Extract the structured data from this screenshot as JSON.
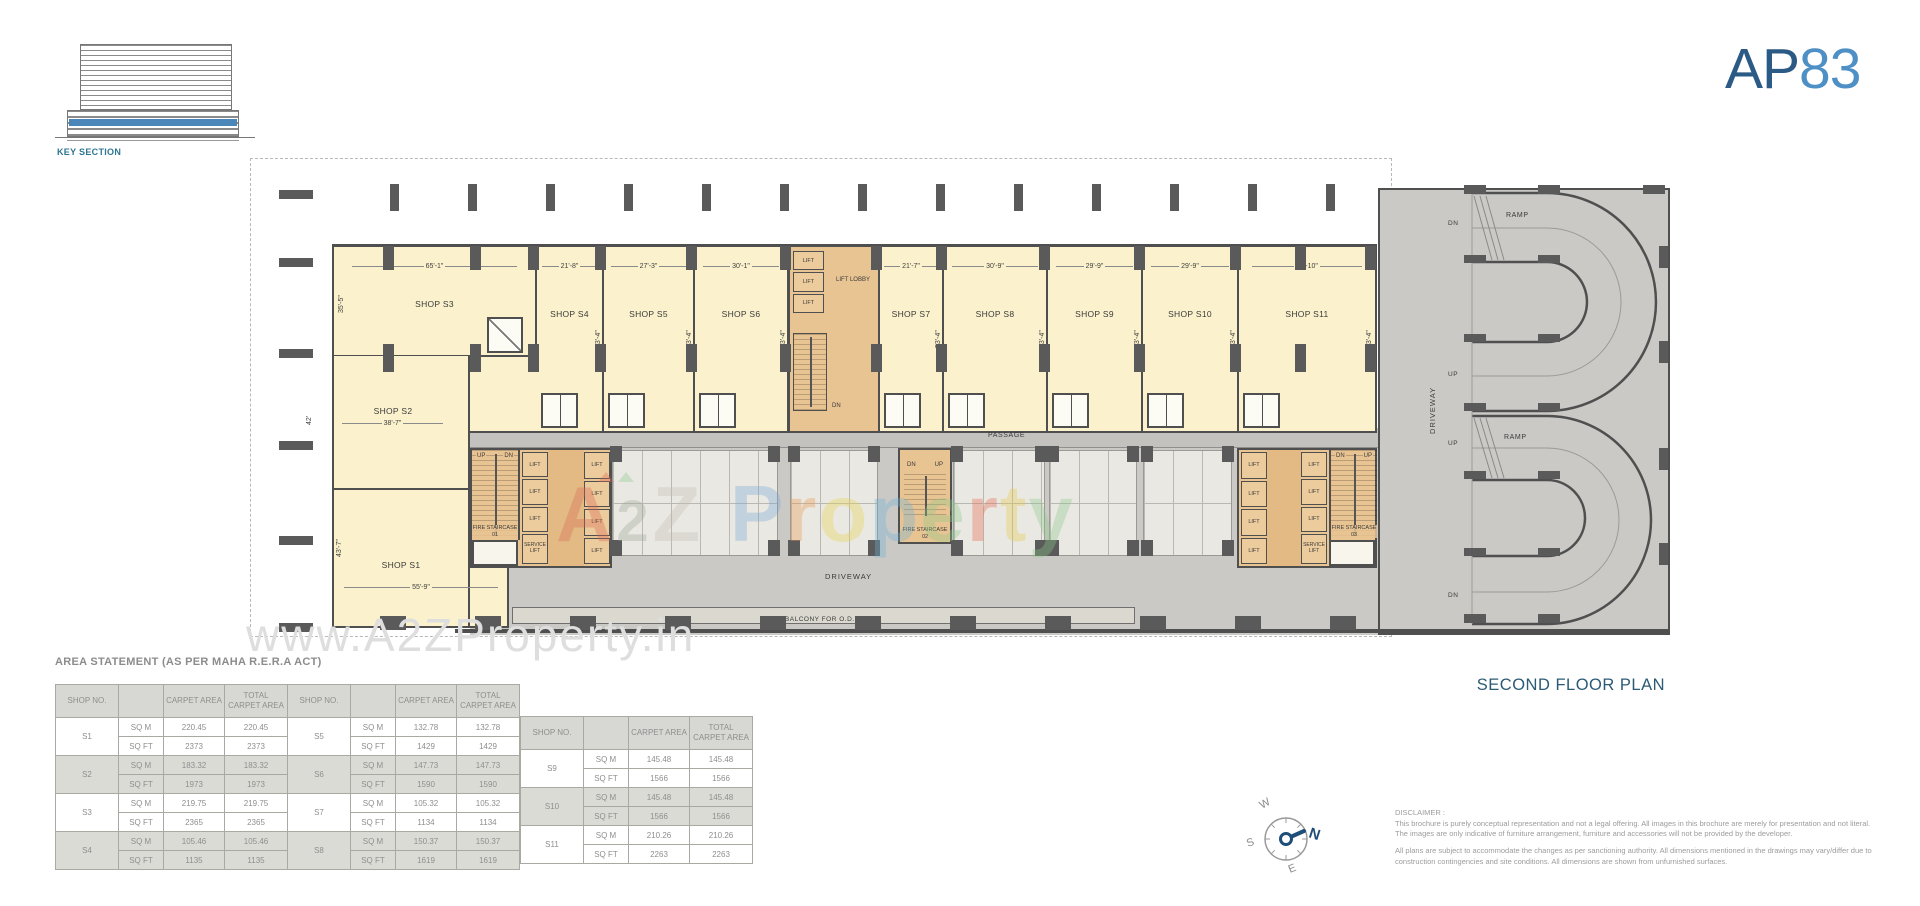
{
  "logo": {
    "prefix": "AP",
    "suffix": "83"
  },
  "key_section": {
    "label": "KEY SECTION"
  },
  "colors": {
    "logo_dark": "#2b5a85",
    "logo_light": "#4e90c5",
    "title_teal": "#2c5b76",
    "plan_cream": "#fbf2cd",
    "core_orange": "#e9c493",
    "wall": "#4f4f4f",
    "key_section_blue": "#4a86b8",
    "compass_north": "#1f4e79"
  },
  "floor_plan": {
    "title": "SECOND FLOOR PLAN",
    "labels": {
      "passage": "PASSAGE",
      "driveway_center": "DRIVEWAY",
      "driveway_right": "DRIVEWAY",
      "balcony": "BALCONY FOR O.D.U.",
      "lift": "LIFT",
      "lift_lobby": "LIFT LOBBY",
      "service_lift": "SERVICE LIFT",
      "fire_staircase_1": "FIRE STAIRCASE 01",
      "fire_staircase_2": "FIRE STAIRCASE 02",
      "fire_staircase_3": "FIRE STAIRCASE 03",
      "ramp": "RAMP",
      "up": "UP",
      "dn": "DN"
    },
    "shops": [
      {
        "id": "S1",
        "name": "SHOP S1",
        "width": "55'-9\"",
        "depth": "43'-7\""
      },
      {
        "id": "S2",
        "name": "SHOP S2",
        "width": "38'-7\"",
        "depth": "42'"
      },
      {
        "id": "S3",
        "name": "SHOP S3",
        "width": "65'-1\"",
        "depth": "35'-5\""
      },
      {
        "id": "S4",
        "name": "SHOP S4",
        "width": "21'-8\"",
        "depth": "53'-4\""
      },
      {
        "id": "S5",
        "name": "SHOP S5",
        "width": "27'-3\"",
        "depth": "53'-4\""
      },
      {
        "id": "S6",
        "name": "SHOP S6",
        "width": "30'-1\"",
        "depth": "53'-4\""
      },
      {
        "id": "S7",
        "name": "SHOP S7",
        "width": "21'-7\"",
        "depth": "53'-4\""
      },
      {
        "id": "S8",
        "name": "SHOP S8",
        "width": "30'-9\"",
        "depth": "53'-4\""
      },
      {
        "id": "S9",
        "name": "SHOP S9",
        "width": "29'-9\"",
        "depth": "53'-4\""
      },
      {
        "id": "S10",
        "name": "SHOP S10",
        "width": "29'-9\"",
        "depth": "53'-4\""
      },
      {
        "id": "S11",
        "name": "SHOP S11",
        "width": "42'-10\"",
        "depth": "53'-4\""
      }
    ]
  },
  "area_statement": {
    "title": "AREA STATEMENT (AS PER MAHA R.E.R.A ACT)",
    "headers": {
      "shop_no": "SHOP NO.",
      "unit": "",
      "carpet": "CARPET AREA",
      "total": "TOTAL CARPET AREA"
    },
    "units": {
      "sqm": "SQ M",
      "sqft": "SQ FT"
    },
    "tables": [
      {
        "rows": [
          {
            "no": "S1",
            "sqm_carpet": "220.45",
            "sqm_total": "220.45",
            "sqft_carpet": "2373",
            "sqft_total": "2373"
          },
          {
            "no": "S2",
            "sqm_carpet": "183.32",
            "sqm_total": "183.32",
            "sqft_carpet": "1973",
            "sqft_total": "1973"
          },
          {
            "no": "S3",
            "sqm_carpet": "219.75",
            "sqm_total": "219.75",
            "sqft_carpet": "2365",
            "sqft_total": "2365"
          },
          {
            "no": "S4",
            "sqm_carpet": "105.46",
            "sqm_total": "105.46",
            "sqft_carpet": "1135",
            "sqft_total": "1135"
          }
        ]
      },
      {
        "rows": [
          {
            "no": "S5",
            "sqm_carpet": "132.78",
            "sqm_total": "132.78",
            "sqft_carpet": "1429",
            "sqft_total": "1429"
          },
          {
            "no": "S6",
            "sqm_carpet": "147.73",
            "sqm_total": "147.73",
            "sqft_carpet": "1590",
            "sqft_total": "1590"
          },
          {
            "no": "S7",
            "sqm_carpet": "105.32",
            "sqm_total": "105.32",
            "sqft_carpet": "1134",
            "sqft_total": "1134"
          },
          {
            "no": "S8",
            "sqm_carpet": "150.37",
            "sqm_total": "150.37",
            "sqft_carpet": "1619",
            "sqft_total": "1619"
          }
        ]
      },
      {
        "rows": [
          {
            "no": "S9",
            "sqm_carpet": "145.48",
            "sqm_total": "145.48",
            "sqft_carpet": "1566",
            "sqft_total": "1566"
          },
          {
            "no": "S10",
            "sqm_carpet": "145.48",
            "sqm_total": "145.48",
            "sqft_carpet": "1566",
            "sqft_total": "1566"
          },
          {
            "no": "S11",
            "sqm_carpet": "210.26",
            "sqm_total": "210.26",
            "sqft_carpet": "2263",
            "sqft_total": "2263"
          }
        ]
      }
    ]
  },
  "compass": {
    "n": "N",
    "s": "S",
    "e": "E",
    "w": "W"
  },
  "disclaimer": {
    "title": "DISCLAIMER :",
    "p1": "This brochure is purely conceptual representation and not a legal offering. All images in this brochure are merely for presentation and not literal. The images are only indicative of furniture arrangement, furniture and accessories will not be provided by the developer.",
    "p2": "All plans are subject to accommodate the changes as per sanctioning authority. All dimensions mentioned in the drawings may vary/differ due to construction contingencies and site conditions. All dimensions are shown from unfurnished surfaces."
  },
  "watermarks": {
    "a2z_letters": [
      "A",
      "2",
      "Z"
    ],
    "property_letters": [
      "P",
      "r",
      "o",
      "p",
      "e",
      "r",
      "t",
      "y"
    ],
    "bottom": "www.A2ZProperty.in"
  }
}
